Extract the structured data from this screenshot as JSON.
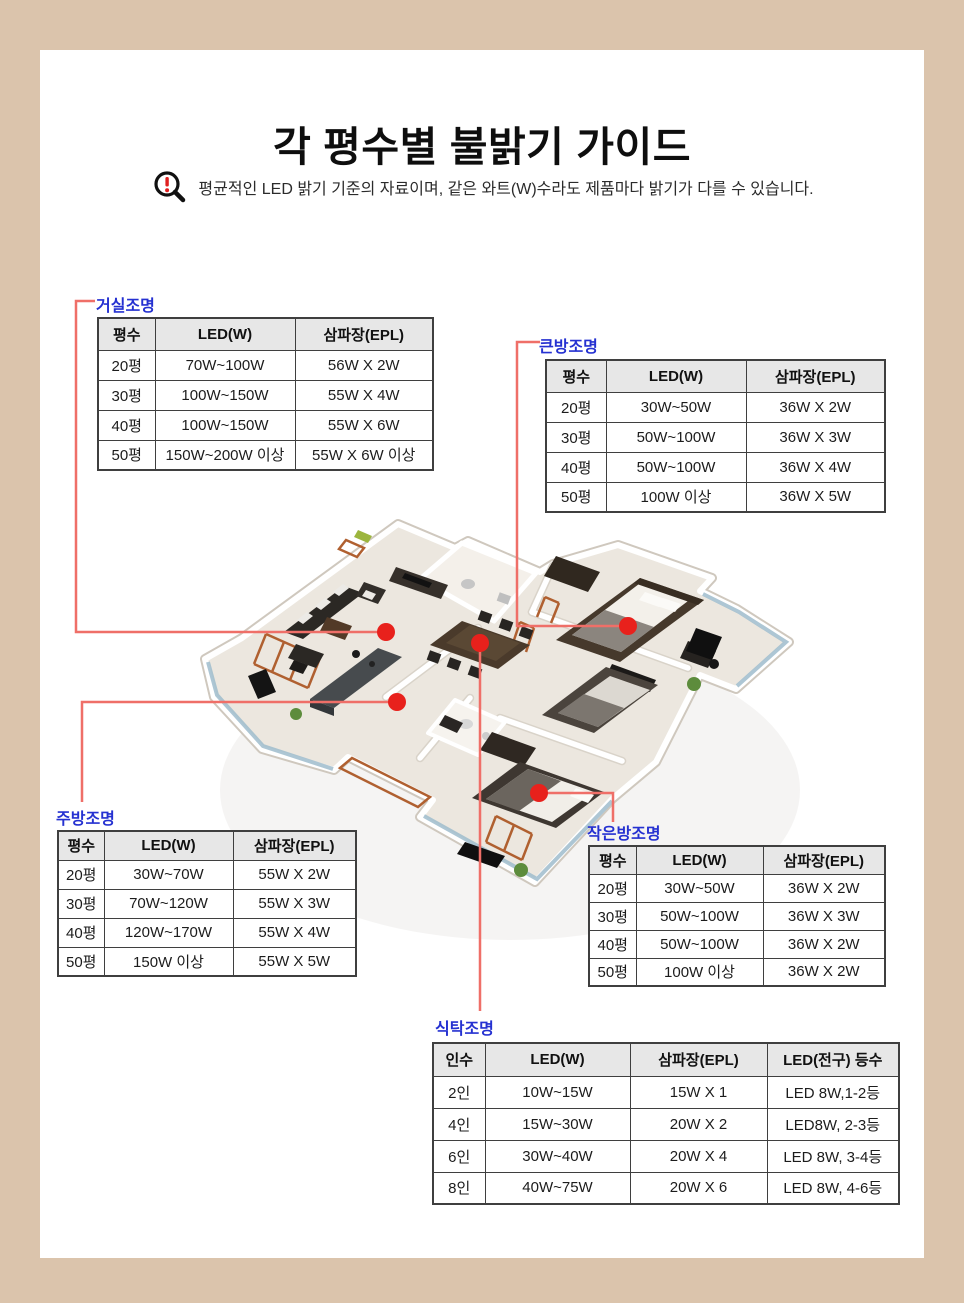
{
  "frame": {
    "background": "#dbc4ac",
    "panel": "#ffffff"
  },
  "header": {
    "title": "각 평수별 불밝기 가이드",
    "notice": "평균적인 LED 밝기 기준의 자료이며, 같은 와트(W)수라도 제품마다 밝기가 다를 수 있습니다.",
    "notice_icon": "magnifier-exclamation-icon"
  },
  "colors": {
    "section_label": "#2531d1",
    "connector_line": "#ef6f68",
    "marker_dot": "#e8211c",
    "table_border": "#3f3f3f",
    "table_header_bg": "#e7e7e7"
  },
  "sections": {
    "living": {
      "label": "거실조명",
      "headers": [
        "평수",
        "LED(W)",
        "삼파장(EPL)"
      ],
      "rows": [
        [
          "20평",
          "70W~100W",
          "56W X 2W"
        ],
        [
          "30평",
          "100W~150W",
          "55W X 4W"
        ],
        [
          "40평",
          "100W~150W",
          "55W X 6W"
        ],
        [
          "50평",
          "150W~200W 이상",
          "55W X 6W 이상"
        ]
      ]
    },
    "big_room": {
      "label": "큰방조명",
      "headers": [
        "평수",
        "LED(W)",
        "삼파장(EPL)"
      ],
      "rows": [
        [
          "20평",
          "30W~50W",
          "36W X 2W"
        ],
        [
          "30평",
          "50W~100W",
          "36W X 3W"
        ],
        [
          "40평",
          "50W~100W",
          "36W X 4W"
        ],
        [
          "50평",
          "100W 이상",
          "36W X 5W"
        ]
      ]
    },
    "kitchen": {
      "label": "주방조명",
      "headers": [
        "평수",
        "LED(W)",
        "삼파장(EPL)"
      ],
      "rows": [
        [
          "20평",
          "30W~70W",
          "55W X 2W"
        ],
        [
          "30평",
          "70W~120W",
          "55W X 3W"
        ],
        [
          "40평",
          "120W~170W",
          "55W X 4W"
        ],
        [
          "50평",
          "150W 이상",
          "55W X 5W"
        ]
      ]
    },
    "small_room": {
      "label": "작은방조명",
      "headers": [
        "평수",
        "LED(W)",
        "삼파장(EPL)"
      ],
      "rows": [
        [
          "20평",
          "30W~50W",
          "36W X 2W"
        ],
        [
          "30평",
          "50W~100W",
          "36W X 3W"
        ],
        [
          "40평",
          "50W~100W",
          "36W X 2W"
        ],
        [
          "50평",
          "100W 이상",
          "36W X 2W"
        ]
      ]
    },
    "dining": {
      "label": "식탁조명",
      "headers": [
        "인수",
        "LED(W)",
        "삼파장(EPL)",
        "LED(전구) 등수"
      ],
      "rows": [
        [
          "2인",
          "10W~15W",
          "15W X 1",
          "LED 8W,1-2등"
        ],
        [
          "4인",
          "15W~30W",
          "20W X 2",
          "LED8W, 2-3등"
        ],
        [
          "6인",
          "30W~40W",
          "20W X 4",
          "LED 8W, 3-4등"
        ],
        [
          "8인",
          "40W~75W",
          "20W X 6",
          "LED 8W, 4-6등"
        ]
      ]
    }
  },
  "floorplan": {
    "markers": [
      "living-room",
      "kitchen",
      "dining-table",
      "big-room",
      "small-room"
    ]
  }
}
